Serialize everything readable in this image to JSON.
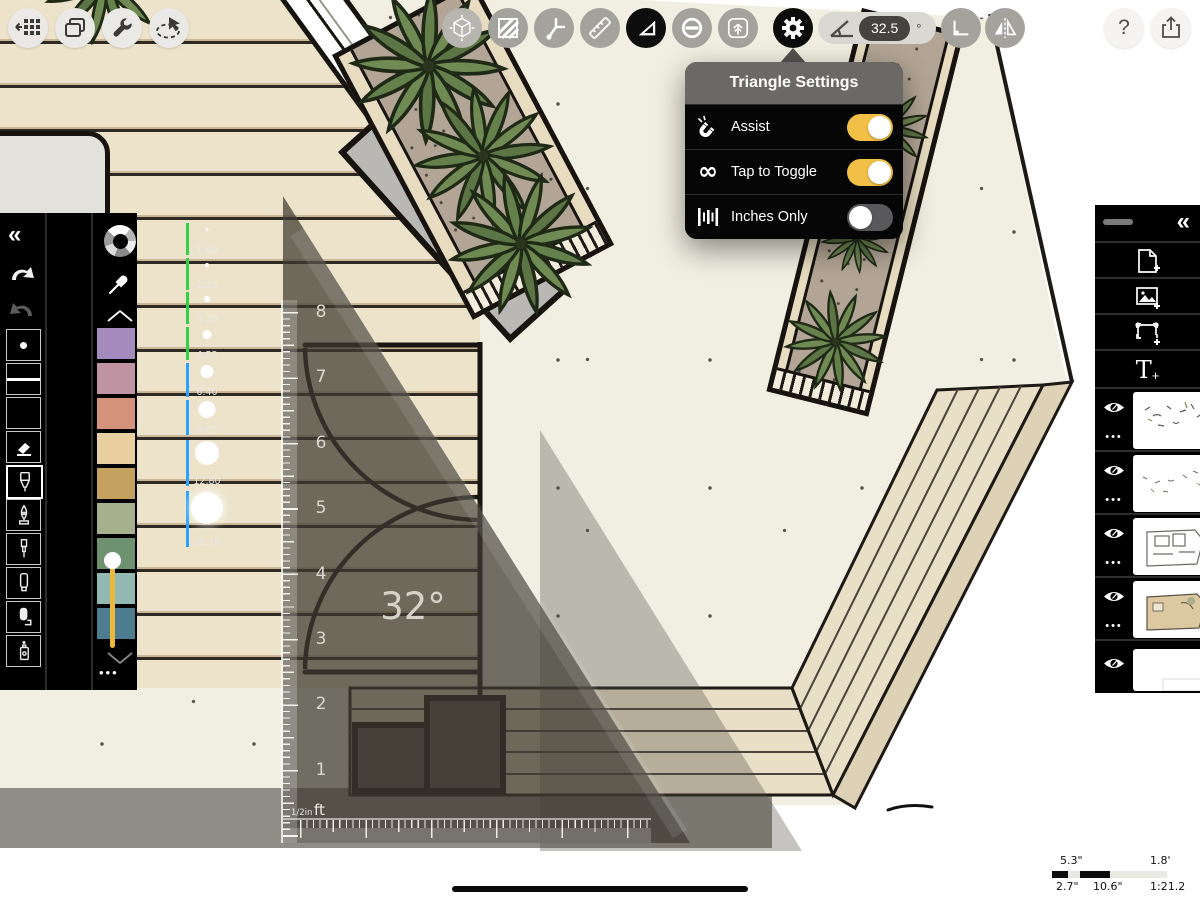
{
  "header": {
    "left_buttons": [
      {
        "name": "gallery",
        "icon": "grid-back-icon"
      },
      {
        "name": "projects",
        "icon": "stacked-pages-icon"
      },
      {
        "name": "tweaks",
        "icon": "wrench-icon"
      },
      {
        "name": "select",
        "icon": "lasso-icon"
      }
    ],
    "tools": [
      {
        "name": "transform-3d",
        "icon": "cube-icon",
        "active": false
      },
      {
        "name": "fill",
        "icon": "hatch-square-icon",
        "active": false
      },
      {
        "name": "fillet",
        "icon": "joint-icon",
        "active": false
      },
      {
        "name": "ruler",
        "icon": "ruler-icon",
        "active": false
      },
      {
        "name": "triangle",
        "icon": "set-square-icon",
        "active": true
      },
      {
        "name": "ellipse",
        "icon": "circle-minus-icon",
        "active": false
      },
      {
        "name": "import",
        "icon": "import-image-icon",
        "active": false
      }
    ],
    "settings_gear": {
      "active": true
    },
    "angle_display": {
      "value": "32.5",
      "unit": "°"
    },
    "right_tools": [
      {
        "name": "snap-corner",
        "icon": "corner-icon"
      },
      {
        "name": "mirror",
        "icon": "flip-icon"
      }
    ],
    "help_label": "?"
  },
  "popup": {
    "title": "Triangle Settings",
    "rows": [
      {
        "icon": "magnet-icon",
        "label": "Assist",
        "on": true
      },
      {
        "icon": "infinity-icon",
        "label": "Tap to Toggle",
        "on": true
      },
      {
        "icon": "inch-marks-icon",
        "label": "Inches Only",
        "on": false
      }
    ],
    "infinity_glyph": "∞",
    "toggle_on_color": "#f2bf47",
    "toggle_off_color": "#59595b"
  },
  "left_panel": {
    "collapse_glyph": "«",
    "brush_sizes": [
      "1.60",
      "2.26",
      "3.20",
      "4.53",
      "6.40",
      "9.05",
      "12.80",
      "18.10"
    ],
    "size_mark_colors": {
      "small": "#35d04a",
      "large": "#2ba2ff"
    },
    "slider_color": "#e9b93b",
    "swatches": [
      "#a58bbd",
      "#bf93a1",
      "#d4917b",
      "#e9cfa0",
      "#c5a160",
      "#a6b08d",
      "#6e9170",
      "#92b8b2",
      "#4d7c8e"
    ],
    "tools": [
      "dot",
      "line",
      "blank",
      "eraser",
      "fineliner",
      "ink-pen",
      "technical-pen",
      "marker",
      "roller",
      "spray"
    ],
    "selected_tool": "fineliner",
    "more_glyph": "•••"
  },
  "right_panel": {
    "collapse_glyph": "«",
    "add_text_glyph": "T",
    "plus_glyph": "+",
    "more_glyph": "•••",
    "layers": [
      {
        "visible": true
      },
      {
        "visible": true
      },
      {
        "visible": true
      },
      {
        "visible": true
      },
      {
        "visible": true
      }
    ]
  },
  "triangle_ruler": {
    "angle_label": "32°",
    "unit_numbers": [
      "8",
      "7",
      "6",
      "5",
      "4",
      "3",
      "2",
      "1"
    ],
    "scale_label": "1/2in",
    "unit_label": "ft"
  },
  "scale_bar": {
    "top_left": "5.3\"",
    "top_right": "1.8'",
    "bottom_left": "2.7\"",
    "bottom_mid": "10.6\"",
    "ratio": "1:21.2"
  }
}
